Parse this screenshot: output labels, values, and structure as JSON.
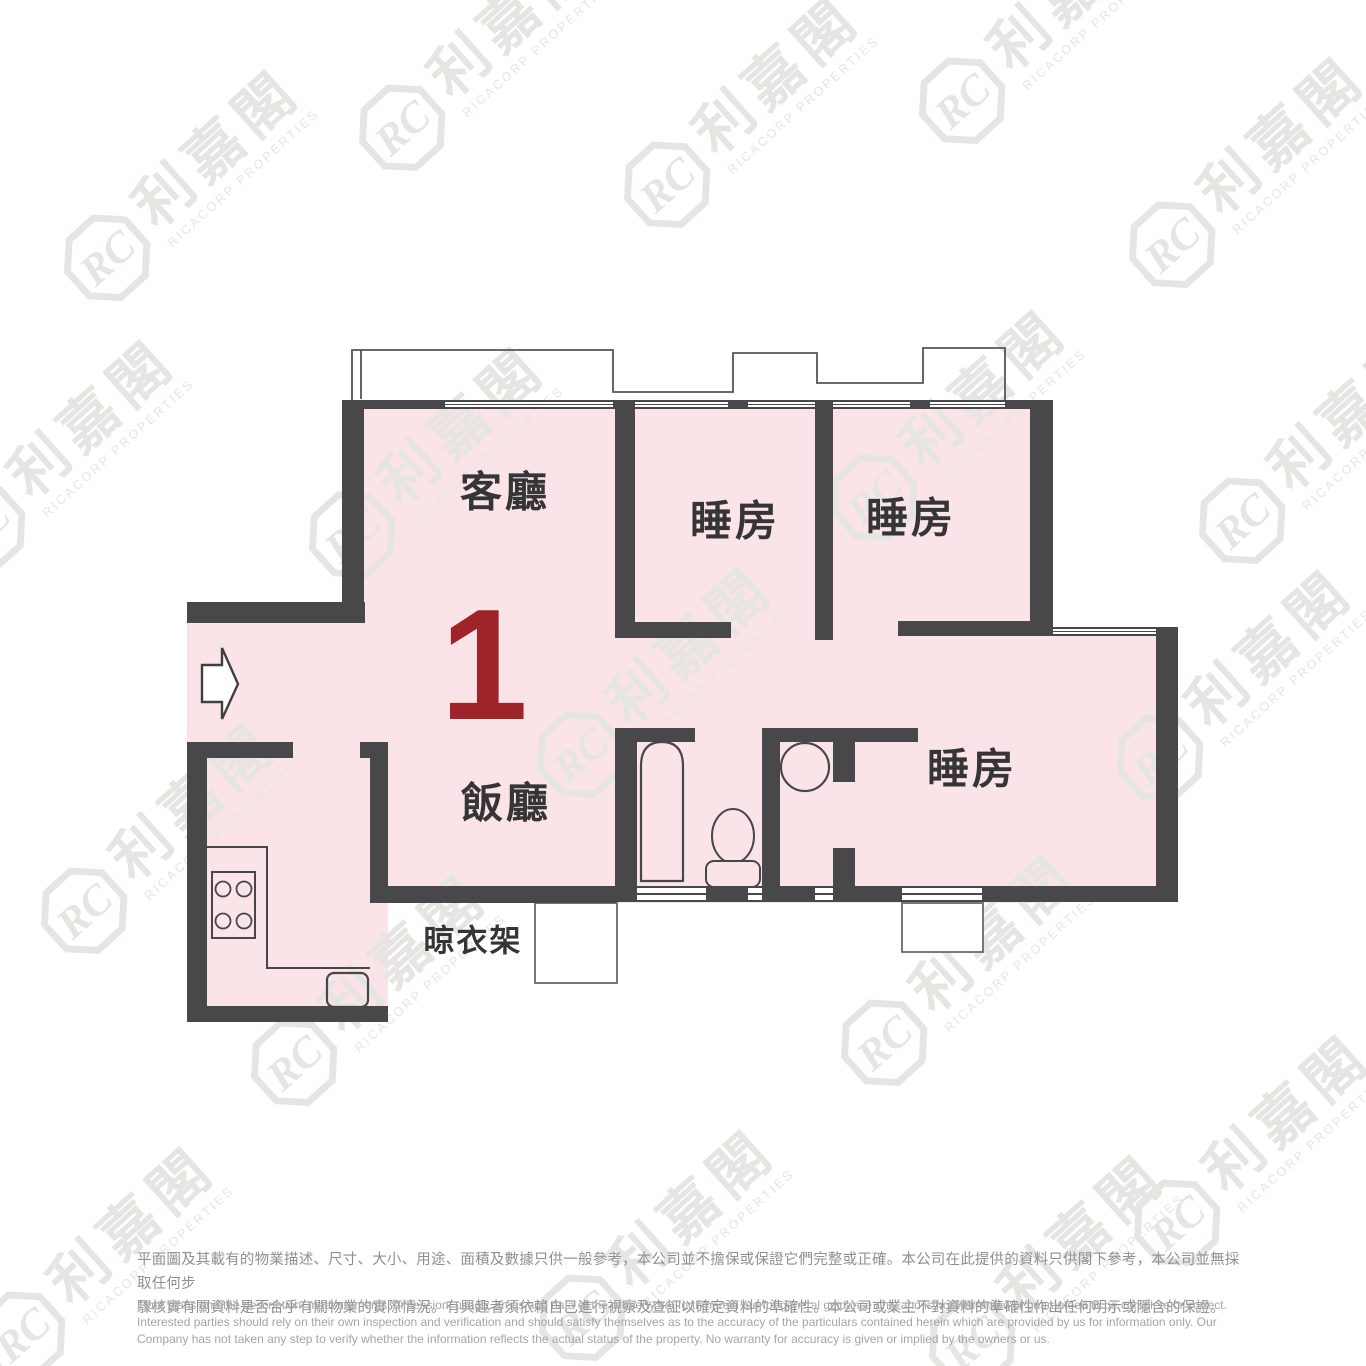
{
  "floor_plan": {
    "unit_number": "1",
    "rooms": {
      "living": "客廳",
      "dining": "飯廳",
      "bedrooms": [
        "睡房",
        "睡房",
        "睡房"
      ],
      "drying_rack": "晾衣架"
    },
    "fixtures": [
      "entrance-arrow",
      "bay-window",
      "window-box",
      "bathtub",
      "toilet",
      "wash-basin",
      "kitchen-counter",
      "stove",
      "sink"
    ],
    "colors": {
      "wall": "#48484a",
      "floor": "#fbe4e8",
      "unit_number": "#9e2429",
      "watermark": "#e7e5e2"
    }
  },
  "watermark": {
    "monogram": "RC",
    "chinese": "利嘉閣",
    "english": "RICACORP PROPERTIES"
  },
  "disclaimer": {
    "zh": [
      "平面圖及其載有的物業描述、尺寸、大小、用途、面積及數據只供一般參考，本公司並不擔保或保證它們完整或正確。本公司在此提供的資料只供閣下參考，本公司並無採取任何步",
      "驟核實有關資料是否合乎有關物業的實際情況。有興趣者須依賴自己進行視察及查証以確定資料的準確性。本公司或業主不對資料的準確性作出任何明示或隱含的保證。"
    ],
    "en": [
      "Floor plans and the description, measurements, dimension, usage, areas and data of the property set forth herein are for general guidance only and is not warranted or guaranteed to be complete or correct.",
      "Interested parties should rely on their own inspection and verification and should satisfy themselves as to the accuracy of the particulars contained herein which are provided by us for information only.  Our",
      "Company has not taken any step to verify whether the information reflects the actual status of the property.  No warranty for accuracy is given or implied by the owners or us."
    ]
  }
}
